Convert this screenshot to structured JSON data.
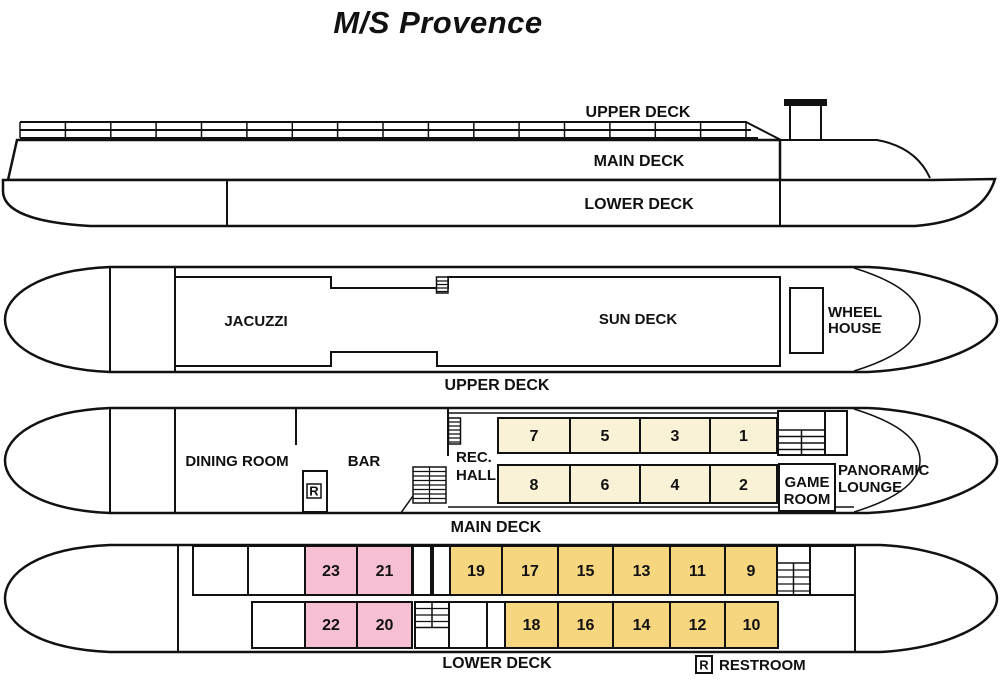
{
  "title": "M/S Provence",
  "side_profile": {
    "upper_deck": "UPPER DECK",
    "main_deck": "MAIN DECK",
    "lower_deck": "LOWER DECK"
  },
  "upper_deck_plan": {
    "caption": "UPPER DECK",
    "jacuzzi": "JACUZZI",
    "sun_deck": "SUN DECK",
    "wheel_house": [
      "WHEEL",
      "HOUSE"
    ]
  },
  "main_deck_plan": {
    "caption": "MAIN DECK",
    "dining_room": "DINING ROOM",
    "bar": "BAR",
    "rec_hall": [
      "REC.",
      "HALL"
    ],
    "game_room": [
      "GAME",
      "ROOM"
    ],
    "panoramic_lounge": [
      "PANORAMIC",
      "LOUNGE"
    ],
    "restroom_symbol": "R",
    "cabins_row1": [
      "7",
      "5",
      "3",
      "1"
    ],
    "cabins_row2": [
      "8",
      "6",
      "4",
      "2"
    ]
  },
  "lower_deck_plan": {
    "caption": "LOWER DECK",
    "cabins_row1": [
      "23",
      "21",
      "19",
      "17",
      "15",
      "13",
      "11",
      "9"
    ],
    "cabins_row2": [
      "22",
      "20",
      "18",
      "16",
      "14",
      "12",
      "10"
    ]
  },
  "legend": {
    "symbol": "R",
    "label": "RESTROOM"
  },
  "colors": {
    "cabin_cream": "#FAF2D6",
    "cabin_yellow": "#F6D67F",
    "cabin_pink": "#F7BFD4",
    "line": "#111111"
  }
}
